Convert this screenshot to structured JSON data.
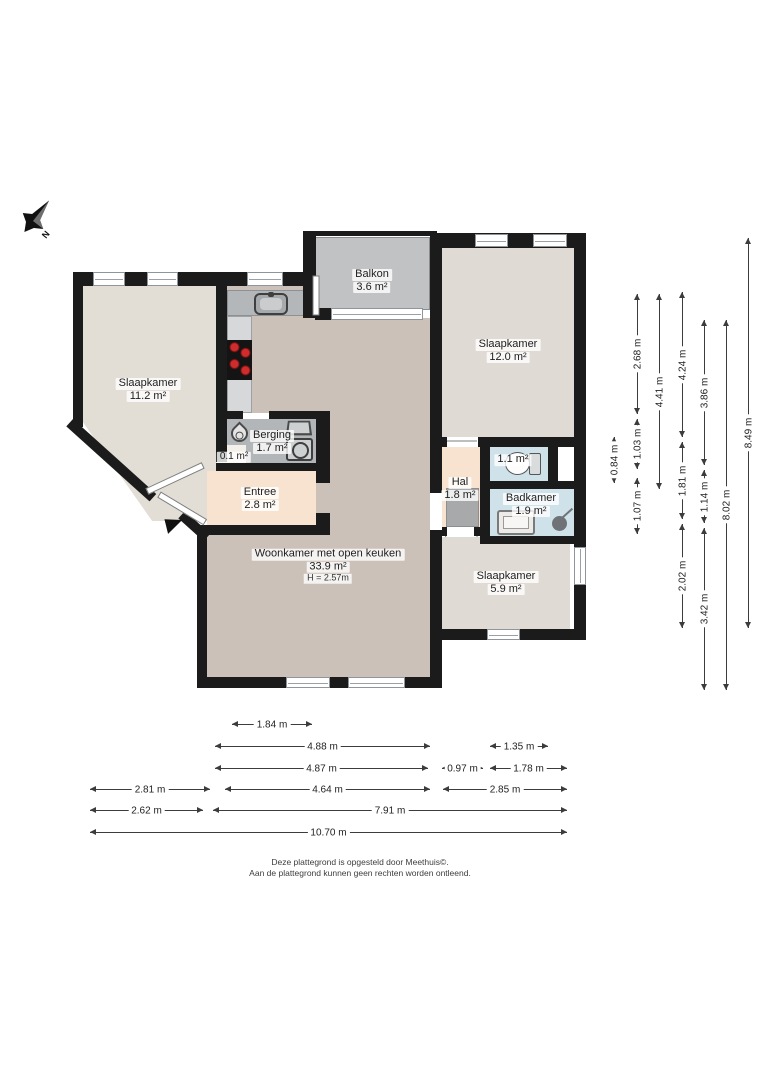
{
  "compass": {
    "label": "N"
  },
  "footer": {
    "line1": "Deze plattegrond is opgesteld door Meethuis©.",
    "line2": "Aan de plattegrond kunnen geen rechten worden ontleend."
  },
  "colors": {
    "wall": "#1b1b1b",
    "living_floor": "#cbc1b8",
    "bedroom_floor": "#dfdad3",
    "entree_floor": "#f7e3d0",
    "wet_floor": "#cfe1e9",
    "storage_floor": "#b3b6b8",
    "balcony_tile": "#c0c2c4",
    "counter": "#b4b7b9",
    "burner_red": "#cf2d2d"
  },
  "room_labels": [
    {
      "id": "slaapkamer-left",
      "cx": 148,
      "cy": 390,
      "lines": [
        "Slaapkamer",
        "11.2 m²"
      ]
    },
    {
      "id": "balkon",
      "cx": 372,
      "cy": 281,
      "lines": [
        "Balkon",
        "3.6 m²"
      ]
    },
    {
      "id": "slaapkamer-right",
      "cx": 508,
      "cy": 351,
      "lines": [
        "Slaapkamer",
        "12.0 m²"
      ]
    },
    {
      "id": "berging",
      "cx": 272,
      "cy": 442,
      "lines": [
        "Berging",
        "1.7 m²"
      ]
    },
    {
      "id": "kast",
      "cx": 234,
      "cy": 457,
      "lines": [
        "0.1 m²"
      ],
      "small": true
    },
    {
      "id": "entree",
      "cx": 260,
      "cy": 499,
      "lines": [
        "Entree",
        "2.8 m²"
      ]
    },
    {
      "id": "hal",
      "cx": 460,
      "cy": 489,
      "lines": [
        "Hal",
        "1.8 m²"
      ]
    },
    {
      "id": "toilet",
      "cx": 513,
      "cy": 460,
      "lines": [
        "1.1 m²"
      ]
    },
    {
      "id": "badkamer",
      "cx": 531,
      "cy": 505,
      "lines": [
        "Badkamer",
        "1.9 m²"
      ]
    },
    {
      "id": "slaapkamer-small",
      "cx": 506,
      "cy": 583,
      "lines": [
        "Slaapkamer",
        "5.9 m²"
      ]
    },
    {
      "id": "woonkamer",
      "cx": 328,
      "cy": 566,
      "lines": [
        "Woonkamer met open keuken",
        "33.9 m²"
      ],
      "sub": "H = 2.57m"
    }
  ],
  "plan": {
    "rooms": [
      {
        "id": "slaapkamer-left",
        "x": 83,
        "y": 286,
        "w": 133,
        "h": 235,
        "c": "#e2ddd5",
        "clip": "polygon(0 0, 100% 0, 100% 100%, 52% 100%, 0 58%)"
      },
      {
        "id": "woonkamer-top",
        "x": 227,
        "y": 286,
        "w": 88,
        "h": 127,
        "c": "#cbc1b8"
      },
      {
        "id": "woonkamer-main",
        "x": 315,
        "y": 318,
        "w": 115,
        "h": 360,
        "c": "#cbc1b8"
      },
      {
        "id": "woonkamer-bottom",
        "x": 207,
        "y": 535,
        "w": 123,
        "h": 143,
        "c": "#cbc1b8"
      },
      {
        "id": "balkon",
        "x": 315,
        "y": 237,
        "w": 115,
        "h": 73,
        "c": "#c0c2c4",
        "tiled": true
      },
      {
        "id": "slaapkamer-right",
        "x": 442,
        "y": 248,
        "w": 132,
        "h": 189,
        "c": "#dfdad3"
      },
      {
        "id": "berging",
        "x": 227,
        "y": 419,
        "w": 89,
        "h": 44,
        "c": "#b3b6b8"
      },
      {
        "id": "kast",
        "x": 216,
        "y": 445,
        "w": 30,
        "h": 18,
        "c": "#f3efe9"
      },
      {
        "id": "entree",
        "x": 207,
        "y": 471,
        "w": 109,
        "h": 54,
        "c": "#f7e3d0"
      },
      {
        "id": "hal",
        "x": 442,
        "y": 447,
        "w": 38,
        "h": 80,
        "c": "#f7e3d0"
      },
      {
        "id": "toilet",
        "x": 490,
        "y": 447,
        "w": 58,
        "h": 34,
        "c": "#cfe1e9"
      },
      {
        "id": "niche",
        "x": 556,
        "y": 449,
        "w": 18,
        "h": 30,
        "c": "#ffffff"
      },
      {
        "id": "badkamer",
        "x": 490,
        "y": 489,
        "w": 86,
        "h": 47,
        "c": "#cfe1e9"
      },
      {
        "id": "slaapkamer-small",
        "x": 442,
        "y": 537,
        "w": 128,
        "h": 92,
        "c": "#dfdad3"
      },
      {
        "id": "kitchen-counter-top",
        "x": 227,
        "y": 290,
        "w": 88,
        "h": 26,
        "c": "#b4b7b9",
        "border": "#8e9194"
      },
      {
        "id": "kitchen-counter-left",
        "x": 227,
        "y": 316,
        "w": 25,
        "h": 97,
        "c": "#d7d8d9",
        "border": "#9ea1a3"
      }
    ],
    "walls": [
      [
        75,
        272,
        237,
        14
      ],
      [
        73,
        272,
        10,
        155
      ],
      [
        303,
        231,
        134,
        5
      ],
      [
        303,
        233,
        13,
        85
      ],
      [
        430,
        233,
        156,
        15
      ],
      [
        574,
        233,
        12,
        407
      ],
      [
        430,
        629,
        156,
        11
      ],
      [
        197,
        677,
        245,
        11
      ],
      [
        197,
        527,
        10,
        161
      ],
      [
        197,
        525,
        133,
        10
      ],
      [
        216,
        286,
        11,
        176
      ],
      [
        227,
        411,
        16,
        8
      ],
      [
        269,
        411,
        61,
        8
      ],
      [
        216,
        463,
        114,
        8
      ],
      [
        316,
        411,
        14,
        72
      ],
      [
        316,
        513,
        14,
        22
      ],
      [
        430,
        248,
        12,
        245
      ],
      [
        430,
        530,
        12,
        147
      ],
      [
        430,
        437,
        17,
        10
      ],
      [
        478,
        437,
        98,
        10
      ],
      [
        480,
        437,
        10,
        107
      ],
      [
        480,
        481,
        96,
        8
      ],
      [
        480,
        536,
        96,
        8
      ],
      [
        442,
        527,
        5,
        9
      ],
      [
        474,
        527,
        8,
        9
      ],
      [
        548,
        447,
        10,
        34
      ],
      [
        315,
        308,
        18,
        12
      ]
    ],
    "dwalls": [
      {
        "x": 73,
        "y": 419,
        "len": 112,
        "ang": 42
      },
      {
        "x": 185,
        "y": 511,
        "len": 34,
        "ang": 42
      }
    ],
    "windows": [
      [
        93,
        272,
        32,
        14
      ],
      [
        147,
        272,
        31,
        14
      ],
      [
        247,
        272,
        36,
        14
      ],
      [
        475,
        234,
        33,
        13
      ],
      [
        533,
        234,
        34,
        13
      ],
      [
        331,
        308,
        92,
        12
      ],
      [
        286,
        677,
        44,
        11
      ],
      [
        348,
        677,
        57,
        11
      ],
      [
        487,
        629,
        33,
        11
      ],
      [
        574,
        547,
        12,
        38
      ]
    ],
    "leaves": [
      {
        "x": 316,
        "y": 272,
        "len": 40,
        "ang": 90
      },
      {
        "x": 159,
        "y": 491,
        "len": 54,
        "ang": 31
      },
      {
        "x": 147,
        "y": 488,
        "len": 62,
        "ang": -25
      }
    ],
    "arcs": [
      {
        "hx": 319,
        "hy": 312,
        "r": 38,
        "a1": -90,
        "a2": 0
      },
      {
        "hx": 237,
        "hy": 415,
        "r": 34,
        "a1": -90,
        "a2": 0
      },
      {
        "hx": 209,
        "hy": 461,
        "r": 36,
        "a1": 95,
        "a2": 172
      },
      {
        "hx": 205,
        "hy": 519,
        "r": 34,
        "a1": 185,
        "a2": 262
      },
      {
        "hx": 322,
        "hy": 512,
        "r": 34,
        "a1": -90,
        "a2": 0
      },
      {
        "hx": 477,
        "hy": 441,
        "r": 33,
        "a1": 180,
        "a2": 270
      },
      {
        "hx": 429,
        "hy": 495,
        "r": 19,
        "a1": 90,
        "a2": 180
      },
      {
        "hx": 429,
        "hy": 530,
        "r": 19,
        "a1": 180,
        "a2": 270
      },
      {
        "hx": 477,
        "hy": 530,
        "r": 32,
        "a1": 90,
        "a2": 180
      },
      {
        "hx": 482,
        "hy": 480,
        "r": 30,
        "a1": 180,
        "a2": 270
      },
      {
        "hx": 482,
        "hy": 492,
        "r": 31,
        "a1": 90,
        "a2": 180
      }
    ],
    "icons": [
      {
        "type": "sink",
        "name": "kitchen-sink-icon",
        "x": 254,
        "y": 293,
        "w": 34,
        "h": 22
      },
      {
        "type": "cooktop",
        "name": "cooktop-icon",
        "x": 227,
        "y": 340,
        "w": 25,
        "h": 40
      },
      {
        "type": "boiler",
        "name": "water-heater-icon",
        "x": 231,
        "y": 425,
        "w": 17,
        "h": 17
      },
      {
        "type": "tub",
        "name": "laundry-tub-icon",
        "x": 287,
        "y": 420,
        "w": 24,
        "h": 15
      },
      {
        "type": "washer",
        "name": "washing-machine-icon",
        "x": 286,
        "y": 438,
        "w": 27,
        "h": 23
      },
      {
        "type": "toilet",
        "name": "toilet-icon",
        "x": 503,
        "y": 451,
        "w": 38,
        "h": 26
      },
      {
        "type": "bsink",
        "name": "bathroom-sink-icon",
        "x": 497,
        "y": 510,
        "w": 38,
        "h": 25
      },
      {
        "type": "shower",
        "name": "shower-icon",
        "x": 550,
        "y": 509,
        "w": 26,
        "h": 22
      },
      {
        "type": "doormat",
        "name": "doormat",
        "x": 446,
        "y": 488,
        "w": 33,
        "h": 39
      },
      {
        "type": "entry-arrow",
        "name": "entrance-marker",
        "x": 166,
        "y": 517,
        "w": 17,
        "h": 15
      }
    ]
  },
  "dims_v": [
    {
      "x": 614,
      "y1": 437,
      "y2": 483,
      "t": "0.84 m"
    },
    {
      "x": 637,
      "y1": 294,
      "y2": 414,
      "t": "2.68 m"
    },
    {
      "x": 637,
      "y1": 419,
      "y2": 469,
      "t": "1.03 m"
    },
    {
      "x": 637,
      "y1": 478,
      "y2": 534,
      "t": "1.07 m"
    },
    {
      "x": 659,
      "y1": 294,
      "y2": 489,
      "t": "4.41 m"
    },
    {
      "x": 682,
      "y1": 292,
      "y2": 437,
      "t": "4.24 m"
    },
    {
      "x": 682,
      "y1": 442,
      "y2": 519,
      "t": "1.81 m"
    },
    {
      "x": 682,
      "y1": 524,
      "y2": 628,
      "t": "2.02 m"
    },
    {
      "x": 704,
      "y1": 320,
      "y2": 465,
      "t": "3.86 m"
    },
    {
      "x": 704,
      "y1": 470,
      "y2": 523,
      "t": "1.14 m"
    },
    {
      "x": 704,
      "y1": 528,
      "y2": 690,
      "t": "3.42 m"
    },
    {
      "x": 726,
      "y1": 320,
      "y2": 690,
      "t": "8.02 m"
    },
    {
      "x": 748,
      "y1": 238,
      "y2": 628,
      "t": "8.49 m"
    }
  ],
  "dims_h": [
    {
      "y": 724,
      "x1": 232,
      "x2": 312,
      "t": "1.84 m"
    },
    {
      "y": 746,
      "x1": 215,
      "x2": 430,
      "t": "4.88 m"
    },
    {
      "y": 746,
      "x1": 490,
      "x2": 548,
      "t": "1.35 m"
    },
    {
      "y": 768,
      "x1": 215,
      "x2": 428,
      "t": "4.87 m"
    },
    {
      "y": 768,
      "x1": 442,
      "x2": 483,
      "t": "0.97 m"
    },
    {
      "y": 768,
      "x1": 490,
      "x2": 567,
      "t": "1.78 m"
    },
    {
      "y": 789,
      "x1": 90,
      "x2": 210,
      "t": "2.81 m"
    },
    {
      "y": 789,
      "x1": 225,
      "x2": 430,
      "t": "4.64 m"
    },
    {
      "y": 789,
      "x1": 443,
      "x2": 567,
      "t": "2.85 m"
    },
    {
      "y": 810,
      "x1": 90,
      "x2": 203,
      "t": "2.62 m"
    },
    {
      "y": 810,
      "x1": 213,
      "x2": 567,
      "t": "7.91 m"
    },
    {
      "y": 832,
      "x1": 90,
      "x2": 567,
      "t": "10.70 m"
    }
  ]
}
